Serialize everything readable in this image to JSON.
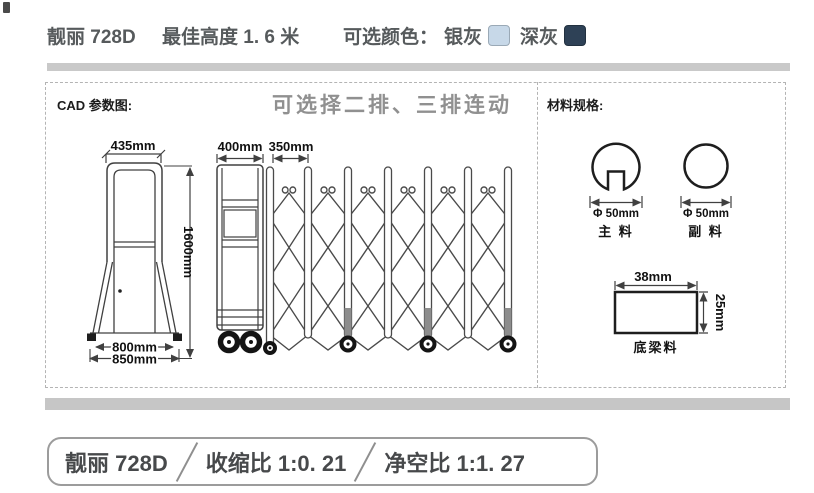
{
  "header": {
    "model": "靓丽 728D",
    "best_height": "最佳高度 1. 6 米",
    "color_label": "可选颜色：",
    "colors": [
      {
        "name": "银灰",
        "hex": "#c7d8e8"
      },
      {
        "name": "深灰",
        "hex": "#2e4156"
      }
    ]
  },
  "cad": {
    "title": "CAD 参数图:",
    "note": "可选择二排、三排连动",
    "front_view": {
      "top_width": "435mm",
      "height": "1600mm",
      "base_width": "800mm",
      "base_total_width": "850mm"
    },
    "extended_view": {
      "trolley_width": "400mm",
      "panel_pitch": "350mm"
    }
  },
  "materials": {
    "title": "材料规格:",
    "main_tube": {
      "dimension": "Φ 50mm",
      "label": "主 料"
    },
    "aux_tube": {
      "dimension": "Φ 50mm",
      "label": "副 料"
    },
    "bottom_beam": {
      "width": "38mm",
      "height": "25mm",
      "label": "底梁料"
    }
  },
  "footer": {
    "model": "靓丽 728D",
    "shrink_ratio": "收缩比 1:0. 21",
    "clearance_ratio": "净空比 1:1. 27"
  }
}
